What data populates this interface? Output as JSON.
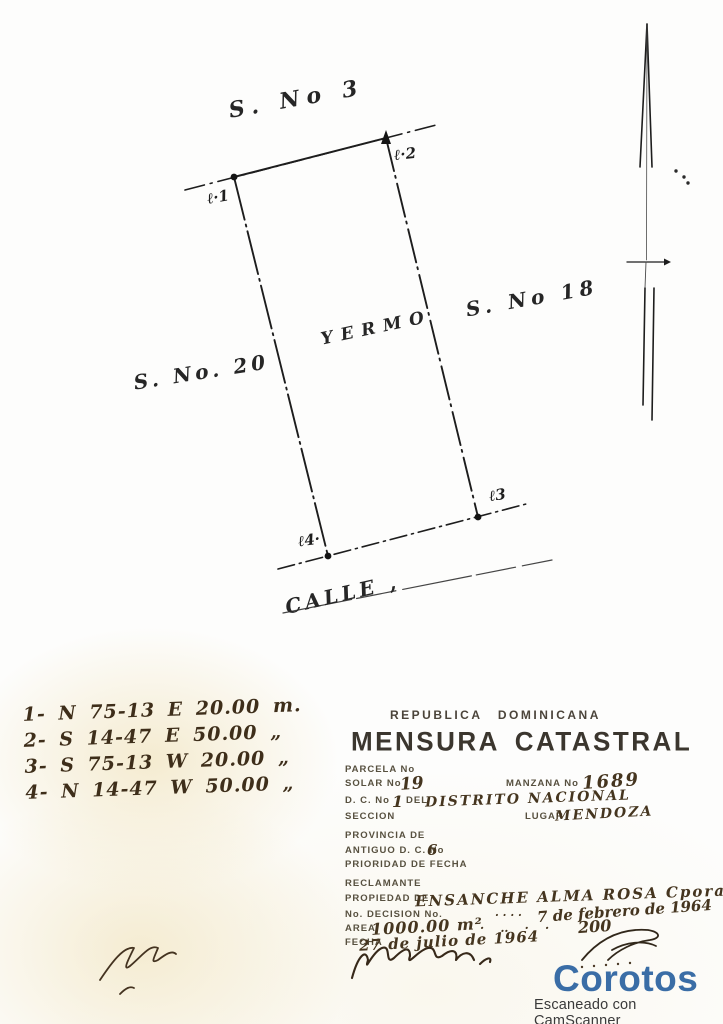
{
  "plan": {
    "street_top": "S. No 3",
    "street_right": "S. No 18",
    "street_left": "S. No. 20",
    "land_use": "YERMO",
    "street_bottom": "CALLE ,",
    "corner_1": "ℓ·1",
    "corner_2": "ℓ·2",
    "corner_3": "ℓ3",
    "corner_4": "ℓ4·"
  },
  "bearings": {
    "line1": "1- N 75-13 E  20.00 m.",
    "line2": "2- S 14-47 E  50.00 „",
    "line3": "3- S 75-13 W  20.00 „",
    "line4": "4- N 14-47 W  50.00 „"
  },
  "form": {
    "country": "REPUBLICA  DOMINICANA",
    "title": "MENSURA CATASTRAL",
    "parcela_label": "PARCELA No",
    "solar_label": "SOLAR No",
    "solar_value": "19",
    "manzana_label": "MANZANA No",
    "manzana_value": "1689",
    "dc_label": "D. C. No",
    "dc_value": "1",
    "dc_del": "DEL",
    "dc_value2": "DISTRITO NACIONAL",
    "seccion_label": "SECCION",
    "lugar_label": "LUGAR",
    "lugar_value": "MENDOZA",
    "provincia_label": "PROVINCIA DE",
    "antiguo_label": "ANTIGUO D. C. No",
    "antiguo_value": "6",
    "prioridad_label": "PRIORIDAD DE FECHA",
    "reclamante_label": "RECLAMANTE",
    "propiedad_label": "PROPIEDAD DE",
    "propiedad_value": "ENSANCHE ALMA ROSA Cpora",
    "decision_label": "No. DECISION No.",
    "decision_dots": "· · · ·",
    "decision_value": "7 de febrero de 1964",
    "area_label": "AREA",
    "area_value": "1000.00 m²",
    "area_dots": "· ‥ · ·",
    "area_extra": "200",
    "fecha_label": "FECHA",
    "fecha_value": "27 de julio de 1964"
  },
  "watermark": {
    "brand": "Corotos",
    "scanner_note": "Escaneado con CamScanner"
  },
  "colors": {
    "brand_blue": "#3a6da6",
    "ink": "#1d1d1d",
    "sepia": "#45351f"
  }
}
